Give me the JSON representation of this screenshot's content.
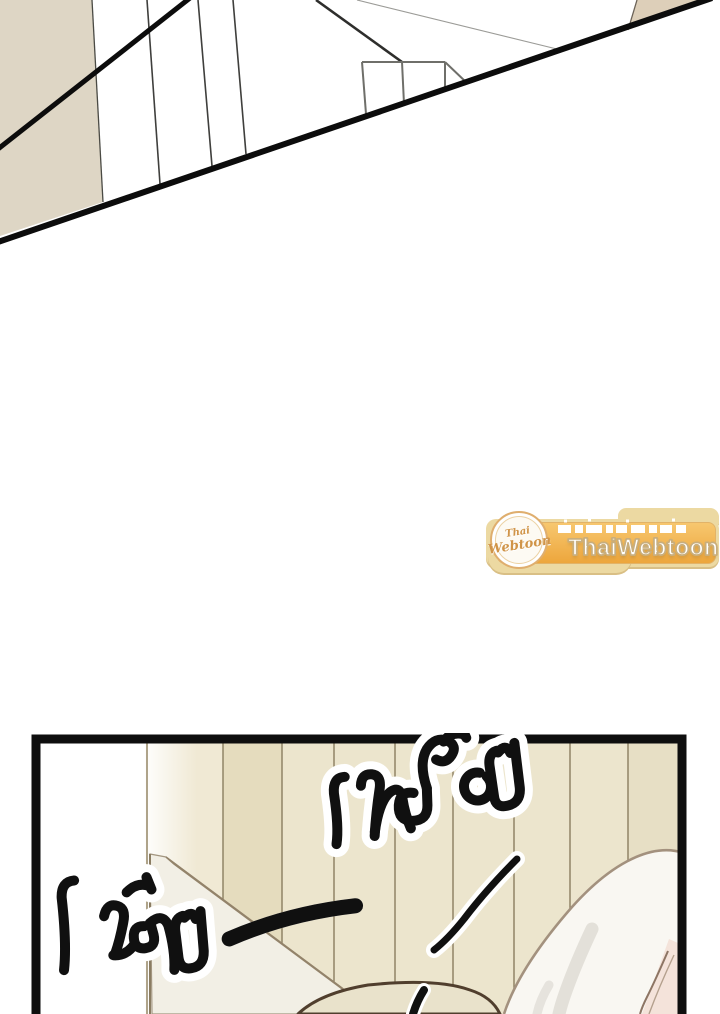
{
  "canvas": {
    "width": 720,
    "height": 1014,
    "background": "#ffffff"
  },
  "top_panel": {
    "colors": {
      "wall_beige_left": "#ded6c5",
      "wall_beige_right": "#ddcfb9",
      "panel_edge_black": "#0c0c0c",
      "sketch_line_gray": "#6f6f6a"
    }
  },
  "watermark": {
    "logo": {
      "line1": "Thai",
      "line2": "Webtoon"
    },
    "tagline": "เว็บสนุกที่แบ่งปันความสุขให้กับทุกคน",
    "site_name": "ThaiWebtoon",
    "colors": {
      "ribbon_tan": "#ecd9a2",
      "ribbon_edge": "#d9bf85",
      "banner_orange_top": "#f7c76f",
      "banner_orange_bottom": "#eda63c",
      "circle_fill": "#fdfaf3",
      "circle_ring": "#dfae6e",
      "logo_text": "#d09448",
      "text_white": "#ffffff",
      "site_name_outline": "#c9ae7c"
    }
  },
  "bottom_panel": {
    "sfx_glance": "เหลือบ",
    "sfx_quiet": "เงียบ—",
    "colors": {
      "plank_cream": "#ece5cd",
      "plank_dark": "#e5dcbe",
      "plank_light": "#f0e9d4",
      "plank_line": "#8a7e60",
      "panel_border": "#0e0e0e",
      "door_face": "#f2efe5",
      "door_edge": "#93836a",
      "hair_white": "#f9f7f2",
      "hair_outline": "#a3917e",
      "hair_streak": "#e3e0d9",
      "strand_brown": "#8d7564",
      "skin_pink": "#f4e3da",
      "head_line": "#503e2d",
      "ink": "#101010",
      "halo": "#ffffff"
    }
  }
}
